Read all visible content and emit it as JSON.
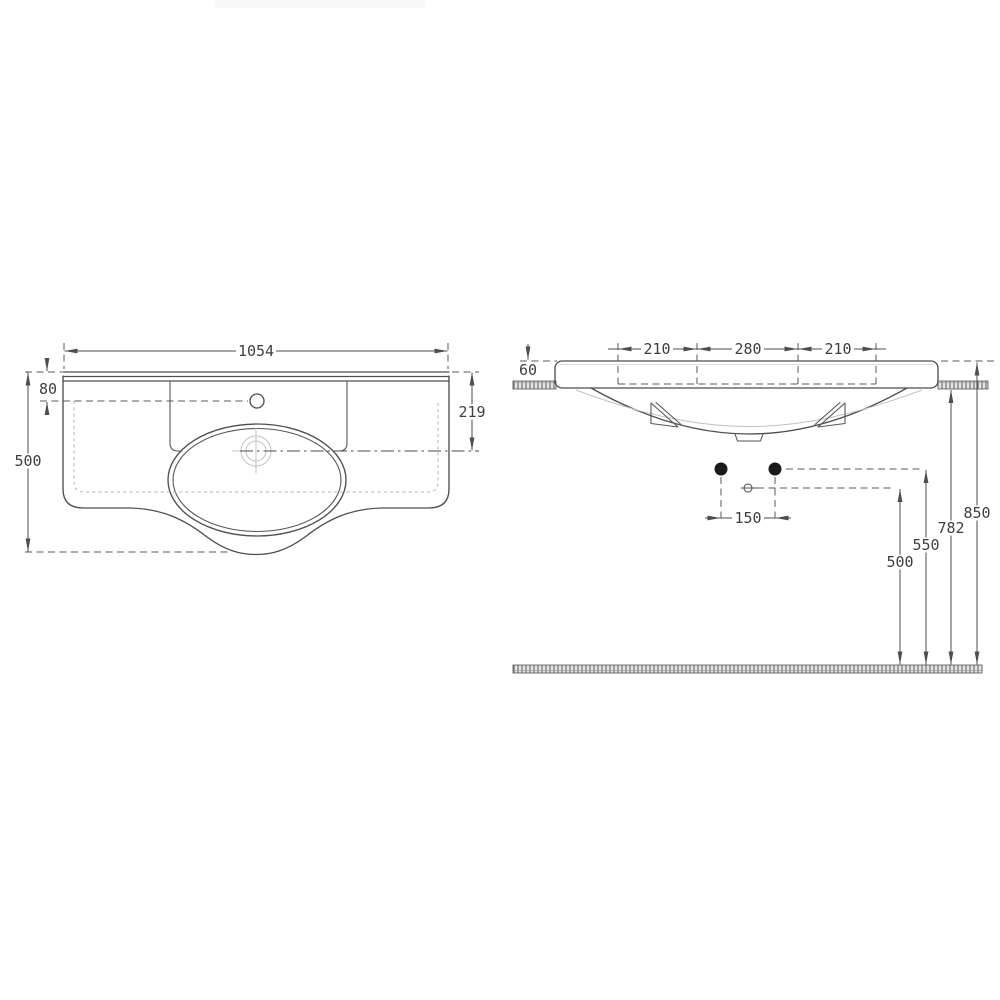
{
  "page": {
    "background": "#ffffff",
    "line_color": "#4e4e4e",
    "hidden_line_color": "#b5b5b5",
    "faint_line_color": "#c2c2c2",
    "text_color": "#3f3f3f",
    "watermark_color": "#f8f8f8"
  },
  "views": {
    "top_view": {
      "dim_overall_width": "1054",
      "dim_back_to_faucet": "80",
      "dim_overall_depth": "500",
      "dim_back_to_drain": "219"
    },
    "front_view": {
      "dim_span_left": "210",
      "dim_span_center": "280",
      "dim_span_right": "210",
      "dim_rim_thickness": "60",
      "dim_fixing_hole_spacing": "150",
      "dim_height_rim_top": "850",
      "dim_height_underside": "782",
      "dim_height_fixing_holes": "550",
      "dim_height_waste_outlet": "500"
    }
  }
}
